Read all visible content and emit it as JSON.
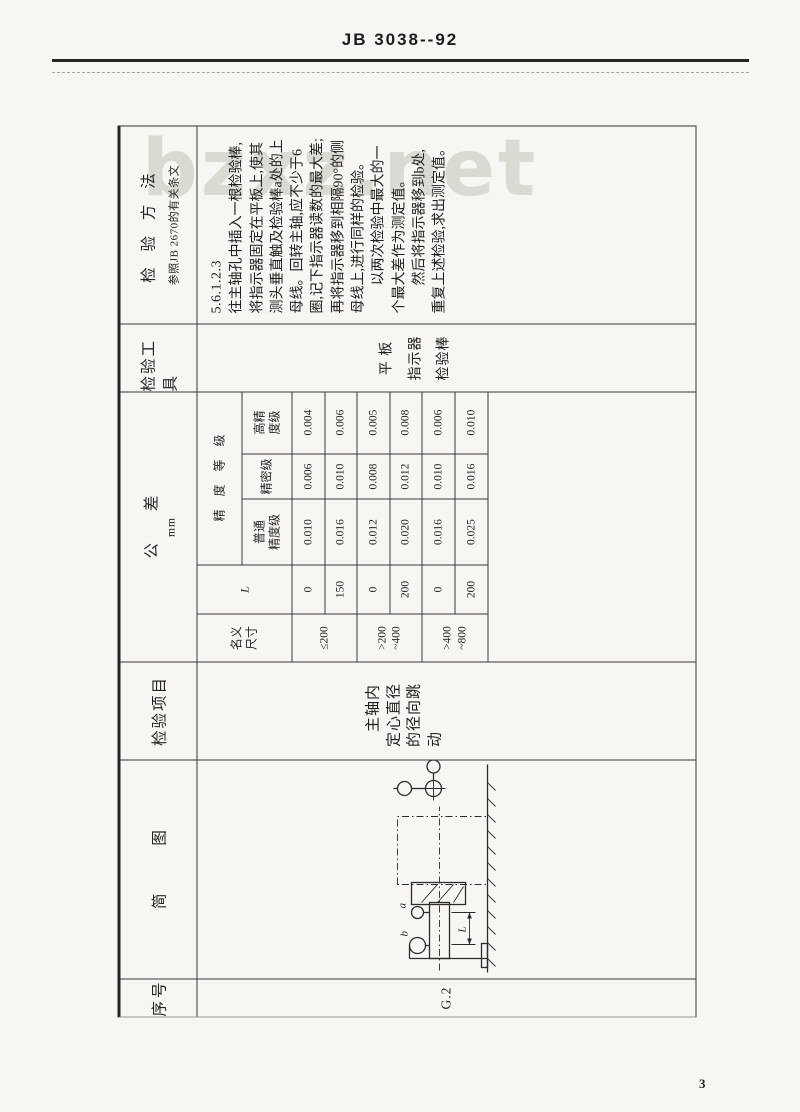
{
  "page": {
    "standard_code": "JB 3038--92",
    "page_number": "3",
    "watermark": "bzxz.net"
  },
  "table": {
    "headers": {
      "serial": "序号",
      "sketch": "简 图",
      "item": "检验项目",
      "tolerance": "公 差",
      "tolerance_unit": "mm",
      "tools": "检验工具",
      "method": "检 验 方 法",
      "method_ref": "参照JB 2670的有关条文"
    },
    "row": {
      "serial": "G.2",
      "item": "主轴内定心直径的径向跳动",
      "tools": "平 板\n指示器\n检验棒",
      "method_paragraphs": [
        "5.6.1.2.3",
        "往主轴孔中插入一根检验棒,将指示器固定在平板上,使其测头垂直触及检验棒a处的上母线。回转主轴,应不少于6圈,记下指示器读数的最大差;再将指示器移到相隔90°的侧母线上,进行同样的检验。",
        "以两次检验中最大的一个最大差作为测定值。",
        "然后将指示器移到b处,重复上述检验,求出测定值。"
      ]
    },
    "tolerance_table": {
      "nominal_size_label": "名义\n尺寸",
      "distance_label": "L",
      "grade_group_label": "精 度 等 级",
      "grade_labels": [
        "普通\n精度级",
        "精密级",
        "高精\n度级"
      ],
      "rows": [
        {
          "size": "≤200",
          "L": "0",
          "ordinary": "0.010",
          "precision": "0.006",
          "high": "0.004"
        },
        {
          "size": "",
          "L": "150",
          "ordinary": "0.016",
          "precision": "0.010",
          "high": "0.006"
        },
        {
          "size": ">200\n~400",
          "L": "0",
          "ordinary": "0.012",
          "precision": "0.008",
          "high": "0.005"
        },
        {
          "size": "",
          "L": "200",
          "ordinary": "0.020",
          "precision": "0.012",
          "high": "0.008"
        },
        {
          "size": ">400\n~800",
          "L": "0",
          "ordinary": "0.016",
          "precision": "0.010",
          "high": "0.006"
        },
        {
          "size": "",
          "L": "200",
          "ordinary": "0.025",
          "precision": "0.016",
          "high": "0.010"
        }
      ]
    },
    "diagram": {
      "label_a": "a",
      "label_b": "b",
      "label_L": "L"
    }
  }
}
